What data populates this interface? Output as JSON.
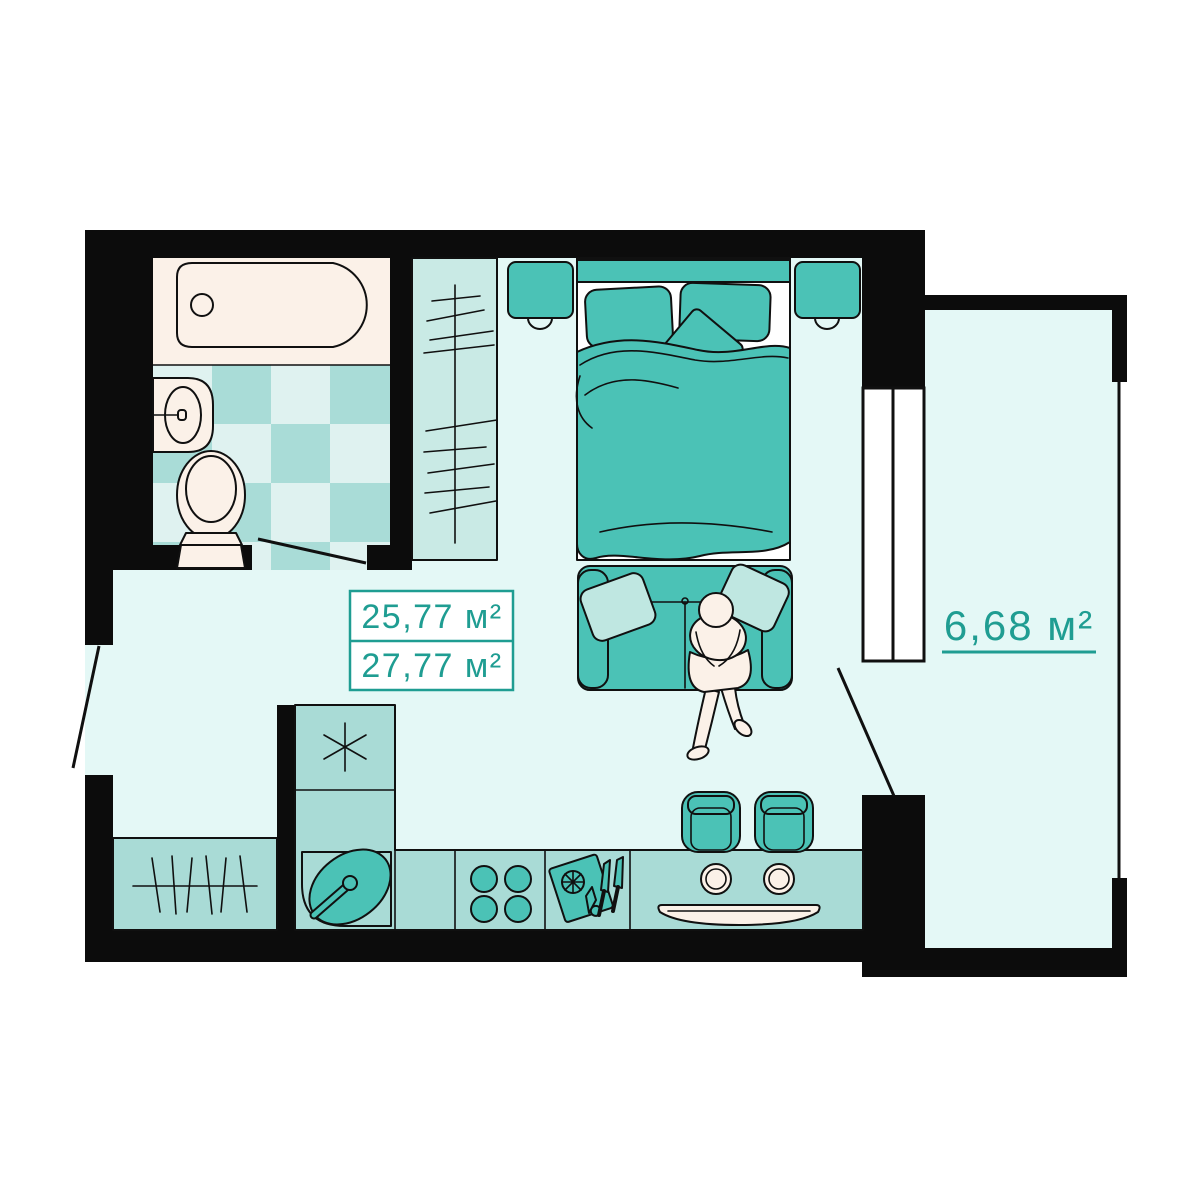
{
  "floor_plan": {
    "unit_areas": {
      "living_area": "25,77 м²",
      "total_area": "27,77 м²",
      "balcony_area": "6,68 м²"
    },
    "colors": {
      "accent_teal_text": "#1F9D92",
      "furniture_teal": "#4BC2B6",
      "furniture_teal_light": "#BFE7E1",
      "counter_teal": "#A9DBD6",
      "wardrobe_teal": "#C9EAE5",
      "floor_cyan": "#E4F8F6",
      "tile_light": "#DFF2F0",
      "tile_dark": "#A9DCD7",
      "fixture_cream": "#FBF1E8",
      "wall_black": "#0C0C0C",
      "background_white": "#FFFFFF"
    }
  }
}
